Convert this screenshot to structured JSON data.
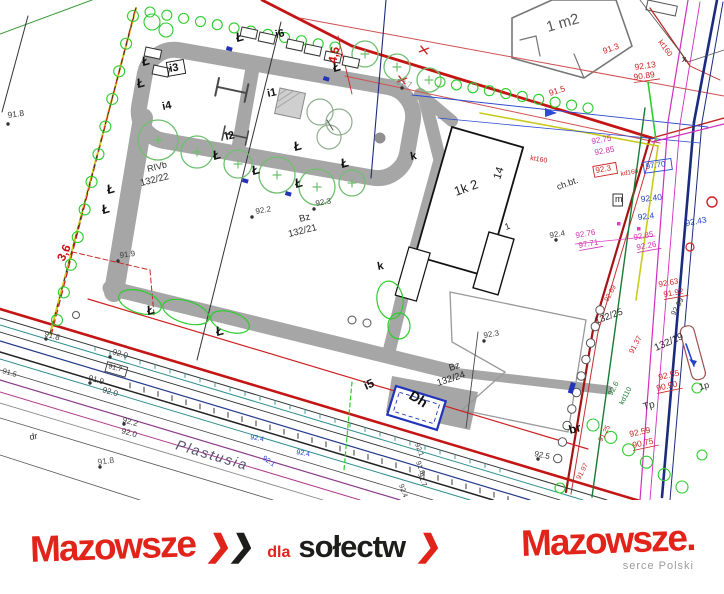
{
  "colors": {
    "boundary_red": "#c41515",
    "survey_red": "#cc2222",
    "path_gray": "#a6a6a6",
    "tree_green": "#6fbf6f",
    "shrub_green": "#2ecc2e",
    "utility_green": "#1a7a33",
    "navy": "#1b2b7e",
    "blue": "#2244cc",
    "magenta": "#cf2fbf",
    "pink": "#d02fb0",
    "teal": "#2d8f8f",
    "purple": "#8b3a8b",
    "yellow": "#c9c91e",
    "brand_red": "#e2231a"
  },
  "map": {
    "street_name": "Plastusia",
    "lamp_glyph": "Ł",
    "lamps": [
      {
        "x": 143,
        "y": 66
      },
      {
        "x": 138,
        "y": 88
      },
      {
        "x": 108,
        "y": 194
      },
      {
        "x": 103,
        "y": 214
      },
      {
        "x": 214,
        "y": 160
      },
      {
        "x": 253,
        "y": 175
      },
      {
        "x": 295,
        "y": 151
      },
      {
        "x": 296,
        "y": 188
      },
      {
        "x": 342,
        "y": 168
      },
      {
        "x": 148,
        "y": 315
      },
      {
        "x": 217,
        "y": 336
      },
      {
        "x": 237,
        "y": 42
      },
      {
        "x": 334,
        "y": 72
      }
    ],
    "labels": [
      {
        "t": "91.8",
        "x": 8,
        "y": 118,
        "r": -8,
        "s": 8.5,
        "c": "#3a3a3a"
      },
      {
        "t": "3,6",
        "x": 64,
        "y": 262,
        "r": -65,
        "s": 12,
        "c": "#cc1111",
        "b": 1
      },
      {
        "t": "91.9",
        "x": 120,
        "y": 258,
        "r": -8,
        "s": 8,
        "c": "#3a3a3a"
      },
      {
        "t": "RIVb",
        "x": 148,
        "y": 172,
        "r": -14,
        "s": 9,
        "c": "#2a2a2a"
      },
      {
        "t": "132/22",
        "x": 141,
        "y": 186,
        "r": -14,
        "s": 9.5,
        "c": "#2a2a2a"
      },
      {
        "t": "i3",
        "x": 170,
        "y": 72,
        "r": -10,
        "s": 11,
        "c": "#111",
        "b": 1,
        "box": 1
      },
      {
        "t": "i4",
        "x": 163,
        "y": 110,
        "r": -12,
        "s": 11,
        "c": "#111",
        "b": 1
      },
      {
        "t": "i2",
        "x": 226,
        "y": 140,
        "r": -12,
        "s": 11,
        "c": "#111",
        "b": 1
      },
      {
        "t": "i1",
        "x": 268,
        "y": 97,
        "r": -12,
        "s": 11,
        "c": "#111",
        "b": 1
      },
      {
        "t": "i6",
        "x": 276,
        "y": 38,
        "r": -12,
        "s": 11,
        "c": "#111",
        "b": 1
      },
      {
        "t": "i5",
        "x": 366,
        "y": 390,
        "r": -24,
        "s": 12,
        "c": "#111",
        "b": 1
      },
      {
        "t": "4,5",
        "x": 336,
        "y": 64,
        "r": -78,
        "s": 12,
        "c": "#cc1111",
        "b": 1
      },
      {
        "t": "97.7",
        "x": 396,
        "y": 84,
        "r": 14,
        "s": 8,
        "c": "#8a8a8a"
      },
      {
        "t": "92.2",
        "x": 256,
        "y": 214,
        "r": -10,
        "s": 8,
        "c": "#3a3a3a"
      },
      {
        "t": "92.3",
        "x": 316,
        "y": 206,
        "r": -10,
        "s": 8,
        "c": "#3a3a3a"
      },
      {
        "t": "Bz",
        "x": 300,
        "y": 222,
        "r": -14,
        "s": 9.5,
        "c": "#2a2a2a"
      },
      {
        "t": "132/21",
        "x": 289,
        "y": 237,
        "r": -14,
        "s": 9.5,
        "c": "#2a2a2a"
      },
      {
        "t": "Bz",
        "x": 450,
        "y": 371,
        "r": -18,
        "s": 9.5,
        "c": "#2a2a2a"
      },
      {
        "t": "132/24",
        "x": 438,
        "y": 386,
        "r": -18,
        "s": 9.5,
        "c": "#2a2a2a"
      },
      {
        "t": "92.3",
        "x": 484,
        "y": 338,
        "r": -10,
        "s": 8,
        "c": "#3a3a3a"
      },
      {
        "t": "92.5",
        "x": 534,
        "y": 456,
        "r": 12,
        "s": 8,
        "c": "#3a3a3a"
      },
      {
        "t": "k",
        "x": 411,
        "y": 160,
        "r": -10,
        "s": 11,
        "c": "#111",
        "b": 1
      },
      {
        "t": "k",
        "x": 378,
        "y": 270,
        "r": -10,
        "s": 11,
        "c": "#111",
        "b": 1
      },
      {
        "t": "1k 2",
        "x": 456,
        "y": 196,
        "r": -20,
        "s": 13,
        "c": "#222"
      },
      {
        "t": "14",
        "x": 500,
        "y": 180,
        "r": -72,
        "s": 11,
        "c": "#222"
      },
      {
        "t": "1",
        "x": 506,
        "y": 230,
        "r": -20,
        "s": 9,
        "c": "#222"
      },
      {
        "t": "ch.bt.",
        "x": 558,
        "y": 190,
        "r": -20,
        "s": 9,
        "c": "#2a2a2a"
      },
      {
        "t": "1 m2",
        "x": 548,
        "y": 32,
        "r": -16,
        "s": 15,
        "c": "#555"
      },
      {
        "t": "kt160",
        "x": 658,
        "y": 42,
        "r": 54,
        "s": 7.5,
        "c": "#cc2222"
      },
      {
        "t": "x",
        "x": 682,
        "y": 62,
        "r": 0,
        "s": 9,
        "c": "#222"
      },
      {
        "t": "91.3",
        "x": 604,
        "y": 54,
        "r": -20,
        "s": 8.5,
        "c": "#cc2222"
      },
      {
        "t": "92.13",
        "x": 635,
        "y": 70,
        "r": -8,
        "s": 8.5,
        "c": "#cc2222"
      },
      {
        "t": "90.89",
        "x": 634,
        "y": 80,
        "r": -8,
        "s": 8.5,
        "c": "#cc2222",
        "u": 1
      },
      {
        "t": "91.5",
        "x": 550,
        "y": 96,
        "r": -18,
        "s": 8.5,
        "c": "#cc2222"
      },
      {
        "t": "kt160",
        "x": 530,
        "y": 160,
        "r": 9,
        "s": 7,
        "c": "#cc2222"
      },
      {
        "t": "92.75",
        "x": 592,
        "y": 144,
        "r": -10,
        "s": 8,
        "c": "#d02fb0"
      },
      {
        "t": "92.85",
        "x": 595,
        "y": 155,
        "r": -10,
        "s": 8,
        "c": "#d02fb0"
      },
      {
        "t": "92.3",
        "x": 596,
        "y": 173,
        "r": -10,
        "s": 8,
        "c": "#cc2222",
        "box": 1
      },
      {
        "t": "kd160",
        "x": 621,
        "y": 176,
        "r": -10,
        "s": 6.5,
        "c": "#cc2222"
      },
      {
        "t": "97.70",
        "x": 646,
        "y": 169,
        "r": -8,
        "s": 8,
        "c": "#2244cc",
        "box": 1
      },
      {
        "t": "m",
        "x": 615,
        "y": 202,
        "r": 0,
        "s": 9,
        "c": "#222",
        "box": 1
      },
      {
        "t": "92.40",
        "x": 641,
        "y": 202,
        "r": -6,
        "s": 8.5,
        "c": "#2244cc"
      },
      {
        "t": "92.4",
        "x": 638,
        "y": 220,
        "r": -6,
        "s": 8.5,
        "c": "#2244cc"
      },
      {
        "t": "92.43",
        "x": 686,
        "y": 226,
        "r": -10,
        "s": 8.5,
        "c": "#2244cc"
      },
      {
        "t": "92.4",
        "x": 550,
        "y": 238,
        "r": -10,
        "s": 8,
        "c": "#3a3a3a"
      },
      {
        "t": "92.76",
        "x": 576,
        "y": 238,
        "r": -10,
        "s": 8,
        "c": "#d02fb0"
      },
      {
        "t": "97.71",
        "x": 579,
        "y": 248,
        "r": -10,
        "s": 8,
        "c": "#d02fb0",
        "u": 1
      },
      {
        "t": "92.85",
        "x": 634,
        "y": 240,
        "r": -10,
        "s": 8,
        "c": "#d02fb0"
      },
      {
        "t": "92.26",
        "x": 637,
        "y": 250,
        "r": -10,
        "s": 8,
        "c": "#d02fb0",
        "u": 1
      },
      {
        "t": "92.63",
        "x": 659,
        "y": 287,
        "r": -10,
        "s": 8,
        "c": "#cc2222"
      },
      {
        "t": "91.92",
        "x": 664,
        "y": 297,
        "r": -10,
        "s": 8,
        "c": "#cc2222",
        "u": 1
      },
      {
        "t": "92.69",
        "x": 608,
        "y": 302,
        "r": -62,
        "s": 7,
        "c": "#cc2222"
      },
      {
        "t": "132/25",
        "x": 596,
        "y": 324,
        "r": -20,
        "s": 9.5,
        "c": "#2a2a2a"
      },
      {
        "t": "92.39",
        "x": 675,
        "y": 316,
        "r": -62,
        "s": 7.5,
        "c": "#3a3a3a"
      },
      {
        "t": "132/19",
        "x": 656,
        "y": 351,
        "r": -24,
        "s": 10,
        "c": "#2a2a2a"
      },
      {
        "t": "91.37",
        "x": 633,
        "y": 354,
        "r": -62,
        "s": 7.5,
        "c": "#cc2222"
      },
      {
        "t": "92.55",
        "x": 659,
        "y": 380,
        "r": -12,
        "s": 8.5,
        "c": "#cc2222"
      },
      {
        "t": "90.90",
        "x": 657,
        "y": 391,
        "r": -12,
        "s": 8.5,
        "c": "#cc2222",
        "u": 1
      },
      {
        "t": "Tp",
        "x": 644,
        "y": 410,
        "r": -15,
        "s": 10,
        "c": "#2a2a2a"
      },
      {
        "t": "1p",
        "x": 700,
        "y": 390,
        "r": -15,
        "s": 9,
        "c": "#2a2a2a"
      },
      {
        "t": "92.6",
        "x": 612,
        "y": 396,
        "r": -62,
        "s": 7.5,
        "c": "#1a7a33"
      },
      {
        "t": "kd110",
        "x": 623,
        "y": 405,
        "r": -62,
        "s": 7,
        "c": "#1a7a33"
      },
      {
        "t": "92.59",
        "x": 630,
        "y": 437,
        "r": -12,
        "s": 8.5,
        "c": "#cc2222"
      },
      {
        "t": "90.75",
        "x": 633,
        "y": 448,
        "r": -12,
        "s": 8.5,
        "c": "#cc2222",
        "u": 1
      },
      {
        "t": "91.25",
        "x": 602,
        "y": 442,
        "r": -62,
        "s": 7,
        "c": "#cc2222"
      },
      {
        "t": "91.97",
        "x": 580,
        "y": 480,
        "r": -62,
        "s": 7,
        "c": "#cc2222"
      },
      {
        "t": "br",
        "x": 570,
        "y": 434,
        "r": -15,
        "s": 12,
        "c": "#111",
        "b": 1
      },
      {
        "t": "91.8",
        "x": 44,
        "y": 336,
        "r": 16,
        "s": 8,
        "c": "#3a3a3a"
      },
      {
        "t": "92.0",
        "x": 112,
        "y": 354,
        "r": 16,
        "s": 8,
        "c": "#3a3a3a"
      },
      {
        "t": "91.7",
        "x": 108,
        "y": 368,
        "r": 16,
        "s": 7,
        "c": "#3a3a3a",
        "box": 1
      },
      {
        "t": "91.5",
        "x": 2,
        "y": 373,
        "r": 16,
        "s": 7.5,
        "c": "#3a3a3a"
      },
      {
        "t": "91.9",
        "x": 88,
        "y": 380,
        "r": 16,
        "s": 8,
        "c": "#3a3a3a"
      },
      {
        "t": "92.0",
        "x": 102,
        "y": 392,
        "r": 16,
        "s": 8,
        "c": "#3a3a3a"
      },
      {
        "t": "92.2",
        "x": 122,
        "y": 422,
        "r": 16,
        "s": 8,
        "c": "#3a3a3a"
      },
      {
        "t": "92.0",
        "x": 121,
        "y": 433,
        "r": 16,
        "s": 8,
        "c": "#3a3a3a"
      },
      {
        "t": "dr",
        "x": 30,
        "y": 440,
        "r": -10,
        "s": 9,
        "c": "#2a2a2a"
      },
      {
        "t": "91.8",
        "x": 98,
        "y": 465,
        "r": -8,
        "s": 8.5,
        "c": "#555"
      },
      {
        "t": "Plastusia",
        "x": 175,
        "y": 449,
        "r": 16.5,
        "s": 14,
        "c": "#50506e",
        "i": 1,
        "sp": 2
      },
      {
        "t": "92.4",
        "x": 250,
        "y": 439,
        "r": 10,
        "s": 7,
        "c": "#2244cc"
      },
      {
        "t": "92.4",
        "x": 296,
        "y": 454,
        "r": 10,
        "s": 7,
        "c": "#2244cc"
      },
      {
        "t": "92.1",
        "x": 262,
        "y": 459,
        "r": 35,
        "s": 7,
        "c": "#2244cc"
      },
      {
        "t": "92.1",
        "x": 415,
        "y": 444,
        "r": 70,
        "s": 7,
        "c": "#3a3a3a"
      },
      {
        "t": "91.8",
        "x": 416,
        "y": 462,
        "r": 70,
        "s": 7,
        "c": "#3a3a3a"
      },
      {
        "t": "91.7",
        "x": 418,
        "y": 474,
        "r": 70,
        "s": 7,
        "c": "#3a3a3a"
      },
      {
        "t": "92.4",
        "x": 399,
        "y": 485,
        "r": 70,
        "s": 7,
        "c": "#3a3a3a"
      },
      {
        "t": "Dh",
        "x": 408,
        "y": 398,
        "r": 32,
        "s": 14,
        "c": "#111",
        "b": 1
      }
    ],
    "point_dots": [
      [
        252,
        217
      ],
      [
        314,
        209
      ],
      [
        118,
        261
      ],
      [
        484,
        341
      ],
      [
        8,
        124
      ],
      [
        46,
        339
      ],
      [
        110,
        357
      ],
      [
        90,
        383
      ],
      [
        124,
        424
      ],
      [
        100,
        467
      ],
      [
        538,
        459
      ],
      [
        556,
        240
      ],
      [
        402,
        88
      ]
    ]
  },
  "footer": {
    "brand_left": "Mazowsze",
    "chevron_glyph": "❯",
    "dla": "dla",
    "solectw": "sołectw",
    "brand_right": "Mazowsze.",
    "tagline": "serce Polski"
  }
}
